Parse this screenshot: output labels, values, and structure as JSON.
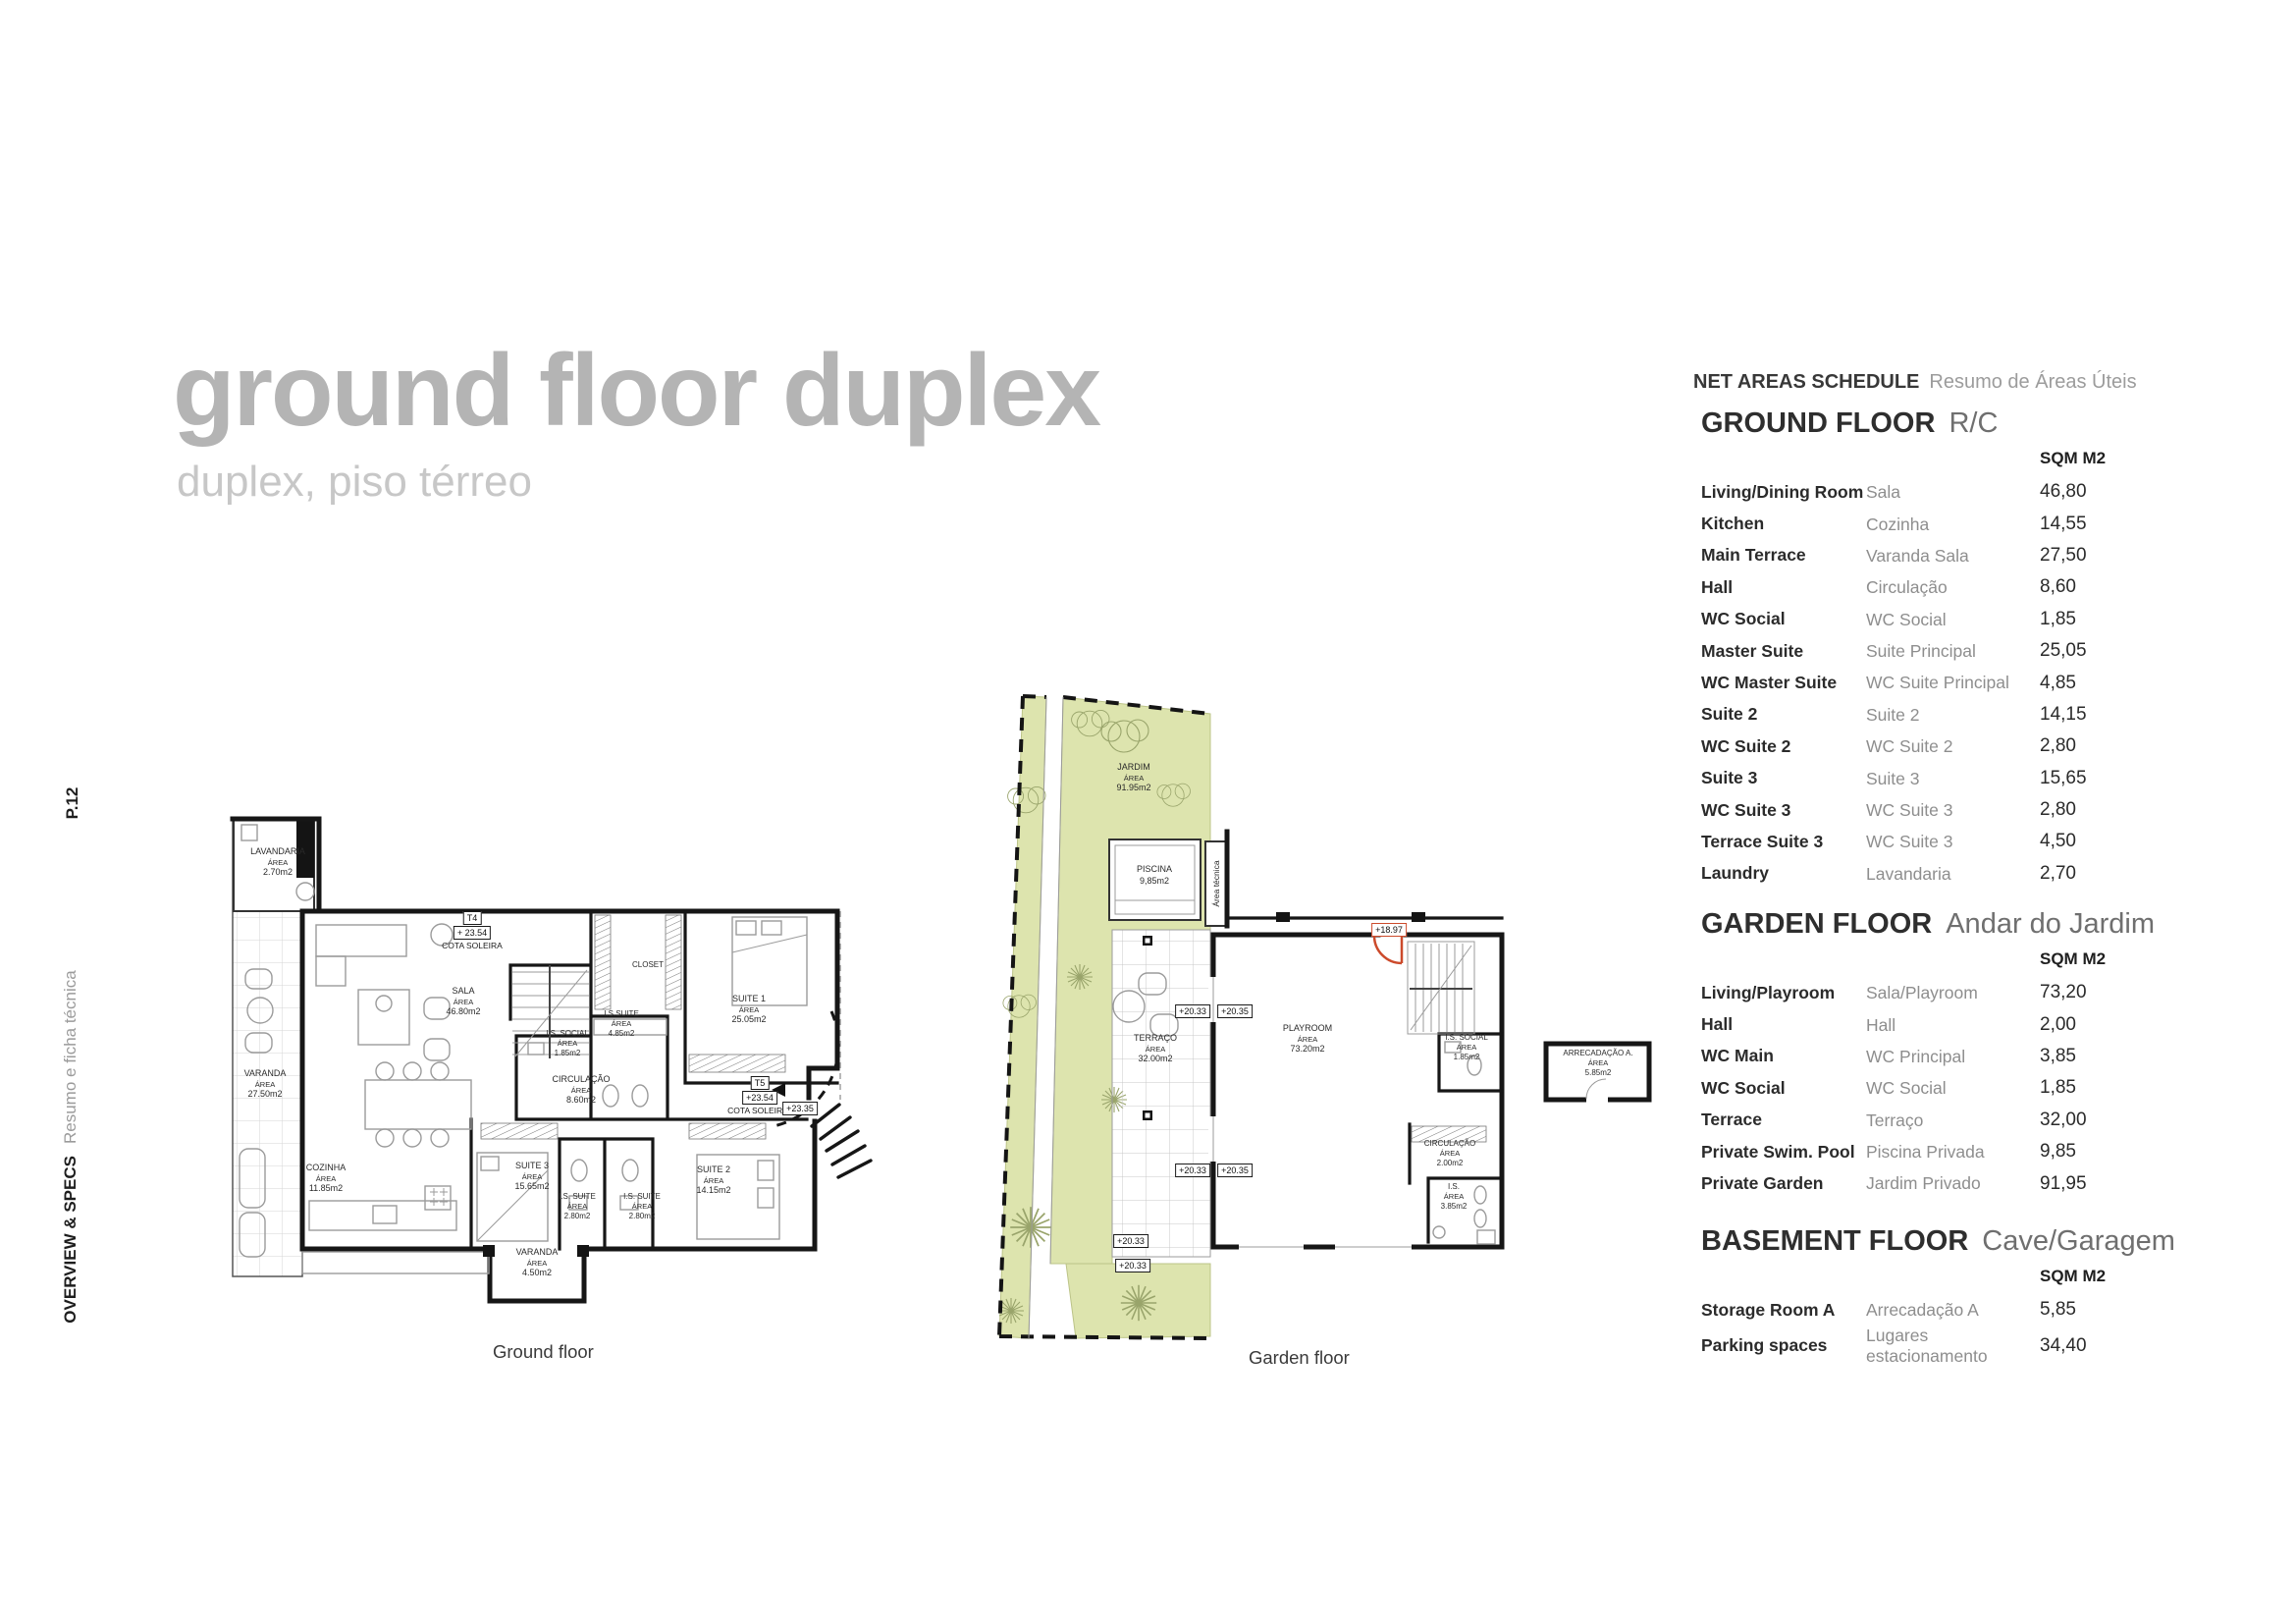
{
  "header": {
    "title": "ground floor duplex",
    "subtitle": "duplex, piso térreo"
  },
  "sidebar": {
    "page_number": "P.12",
    "title": "OVERVIEW & SPECS",
    "subtitle": "Resumo e ficha técnica"
  },
  "schedule": {
    "title": "NET AREAS SCHEDULE",
    "title_pt": "Resumo de Áreas Úteis",
    "unit": "SQM M2",
    "sections": [
      {
        "name": "GROUND FLOOR",
        "name_pt": "R/C",
        "rows": [
          [
            "Living/Dining Room",
            "Sala",
            "46,80"
          ],
          [
            "Kitchen",
            "Cozinha",
            "14,55"
          ],
          [
            "Main Terrace",
            "Varanda Sala",
            "27,50"
          ],
          [
            "Hall",
            "Circulação",
            "8,60"
          ],
          [
            "WC Social",
            "WC Social",
            "1,85"
          ],
          [
            "Master Suite",
            "Suite Principal",
            "25,05"
          ],
          [
            "WC Master Suite",
            "WC Suite Principal",
            "4,85"
          ],
          [
            "Suite 2",
            "Suite 2",
            "14,15"
          ],
          [
            "WC Suite 2",
            "WC Suite 2",
            "2,80"
          ],
          [
            "Suite 3",
            "Suite 3",
            "15,65"
          ],
          [
            "WC Suite 3",
            "WC Suite 3",
            "2,80"
          ],
          [
            "Terrace Suite 3",
            "WC Suite 3",
            "4,50"
          ],
          [
            "Laundry",
            "Lavandaria",
            "2,70"
          ]
        ]
      },
      {
        "name": "GARDEN FLOOR",
        "name_pt": "Andar do Jardim",
        "rows": [
          [
            "Living/Playroom",
            "Sala/Playroom",
            "73,20"
          ],
          [
            "Hall",
            "Hall",
            "2,00"
          ],
          [
            "WC Main",
            "WC Principal",
            "3,85"
          ],
          [
            "WC Social",
            "WC Social",
            "1,85"
          ],
          [
            "Terrace",
            "Terraço",
            "32,00"
          ],
          [
            "Private Swim. Pool",
            "Piscina Privada",
            "9,85"
          ],
          [
            "Private Garden",
            "Jardim Privado",
            "91,95"
          ]
        ]
      },
      {
        "name": "BASEMENT FLOOR",
        "name_pt": "Cave/Garagem",
        "rows": [
          [
            "Storage Room A",
            "Arrecadação A",
            "5,85"
          ],
          [
            "Parking spaces",
            "Lugares estacionamento",
            "34,40"
          ]
        ]
      }
    ]
  },
  "plans": {
    "area_word": "ÁREA",
    "ground": {
      "caption": "Ground floor",
      "rooms": [
        {
          "name": "LAVANDARIA",
          "area": "2.70m2"
        },
        {
          "name": "SALA",
          "area": "46.80m2"
        },
        {
          "name": "VARANDA",
          "area": "27.50m2"
        },
        {
          "name": "COZINHA",
          "area": "11.85m2"
        },
        {
          "name": "SUITE 3",
          "area": "15.65m2"
        },
        {
          "name": "I.S. SUITE",
          "area": "2.80m2"
        },
        {
          "name": "I.S. SUITE",
          "area": "2.80m2"
        },
        {
          "name": "SUITE 2",
          "area": "14.15m2"
        },
        {
          "name": "SUITE 1",
          "area": "25.05m2"
        },
        {
          "name": "I.S.SUITE",
          "area": "4.85m2"
        },
        {
          "name": "I.S. SOCIAL",
          "area": "1.85m2"
        },
        {
          "name": "CIRCULAÇÃO",
          "area": "8.60m2"
        },
        {
          "name": "VARANDA",
          "area": "4.50m2"
        },
        {
          "name": "CLOSET"
        }
      ],
      "annotations": {
        "t4": "T4",
        "t5": "T5",
        "cota": "COTA SOLEIRA",
        "level_t4": "+ 23.54",
        "level_t5": "+23.54",
        "level_entry": "+23.35"
      }
    },
    "garden": {
      "caption": "Garden floor",
      "rooms": [
        {
          "name": "JARDIM",
          "area": "91.95m2"
        },
        {
          "name": "PISCINA",
          "area": "9,85m2"
        },
        {
          "name": "TERRAÇO",
          "area": "32.00m2"
        },
        {
          "name": "PLAYROOM",
          "area": "73.20m2"
        },
        {
          "name": "I.S. SOCIAL",
          "area": "1.85m2"
        },
        {
          "name": "CIRCULAÇÃO",
          "area": "2.00m2"
        },
        {
          "name": "I.S.",
          "area": "3.85m2"
        },
        {
          "name": "ARRECADAÇÃO A.",
          "area": "5.85m2"
        }
      ],
      "annotations": {
        "tech_area": "Área técnica",
        "lv_a": "+20.33",
        "lv_b": "+20.35",
        "lv_door": "+18.97"
      }
    }
  },
  "colors": {
    "accent_red": "#cc4a2b",
    "garden_green": "#dde4ae",
    "title_gray": "#b4b4b4"
  }
}
